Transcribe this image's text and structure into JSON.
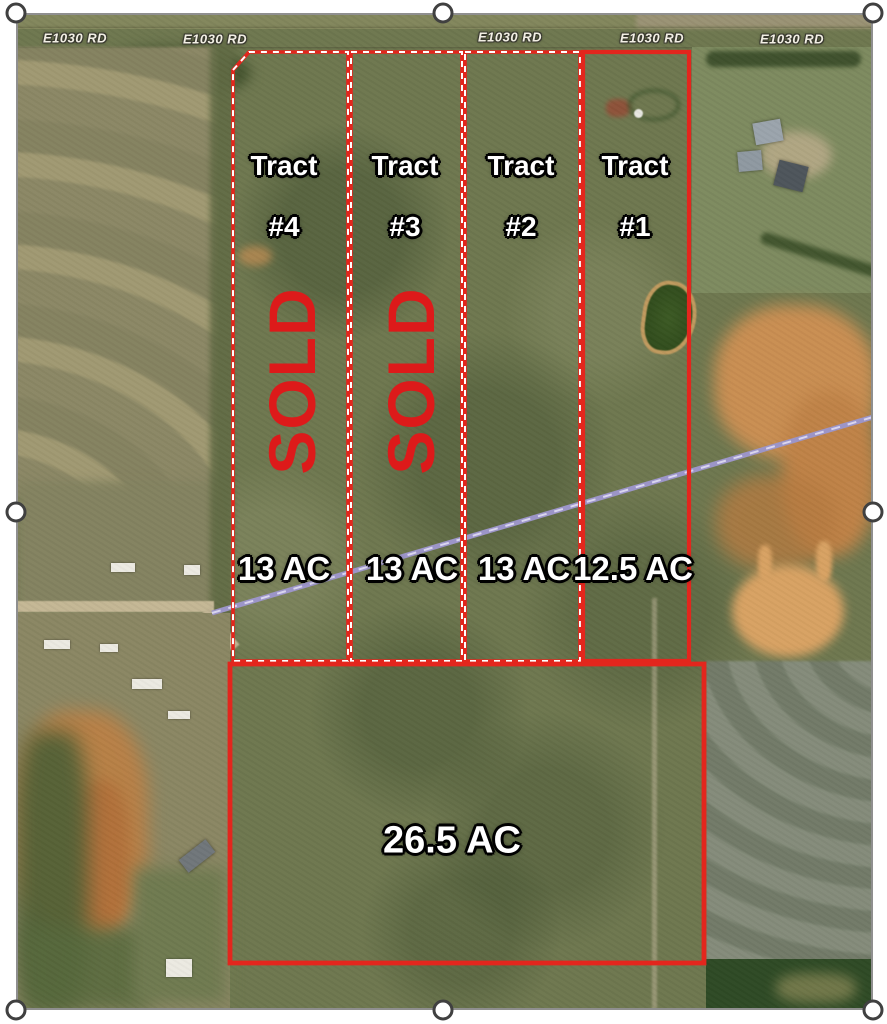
{
  "road_labels": [
    "E1030 RD",
    "E1030 RD",
    "E1030 RD",
    "E1030 RD",
    "E1030 RD"
  ],
  "tracts": {
    "tract_1": {
      "name": "Tract",
      "number": "#1",
      "acreage": "12.5 AC"
    },
    "tract_2": {
      "name": "Tract",
      "number": "#2",
      "acreage": "13 AC"
    },
    "tract_3": {
      "name": "Tract",
      "number": "#3",
      "acreage": "13 AC",
      "status": "SOLD"
    },
    "tract_4": {
      "name": "Tract",
      "number": "#4",
      "acreage": "13 AC",
      "status": "SOLD"
    },
    "tract_5": {
      "name": "Tract #5",
      "acreage": "26.5 AC"
    }
  },
  "colors": {
    "boundary_red": "#e3261d",
    "sold_red": "#dd1a1a",
    "easement_purple": "#9c95c8",
    "label_text": "#ffffff",
    "road_surface": "#c3b795"
  },
  "icons": {
    "selection_handle": "circle"
  }
}
